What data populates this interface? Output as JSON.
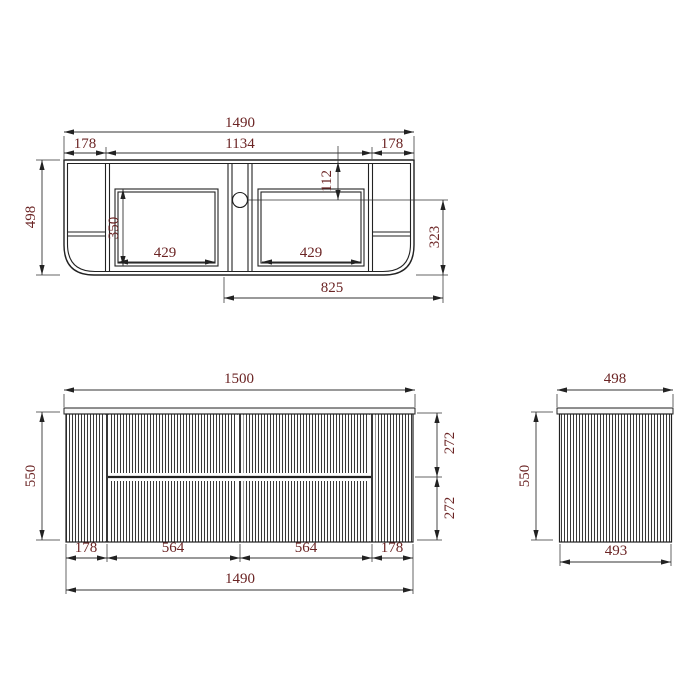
{
  "drawing": {
    "kind": "technical dimension drawing",
    "product": "wall-hung fluted vanity cabinet (3 orthographic views)",
    "colors": {
      "dimension_text": "#6b2424",
      "lines": "#222222",
      "background": "#ffffff"
    },
    "views": {
      "plan": {
        "label": "plan view (top)",
        "dims": {
          "overall_width": "1490",
          "left_end_width": "178",
          "inner_span": "1134",
          "right_end_width": "178",
          "overall_depth": "498",
          "faucet_hole_setback": "112",
          "basin_cutout_depth": "350",
          "basin_cutout_width_left": "429",
          "basin_cutout_width_right": "429",
          "centerline_to_bottom": "323",
          "center_to_right_span": "825"
        }
      },
      "front": {
        "label": "front elevation",
        "dims": {
          "top_width": "1500",
          "overall_height": "550",
          "upper_drawer_height": "272",
          "lower_drawer_height": "272",
          "left_end_width": "178",
          "left_door_width": "564",
          "right_door_width": "564",
          "right_end_width": "178",
          "cabinet_width": "1490"
        }
      },
      "side": {
        "label": "side elevation",
        "dims": {
          "top_depth": "498",
          "overall_height": "550",
          "cabinet_depth": "493"
        }
      }
    }
  }
}
